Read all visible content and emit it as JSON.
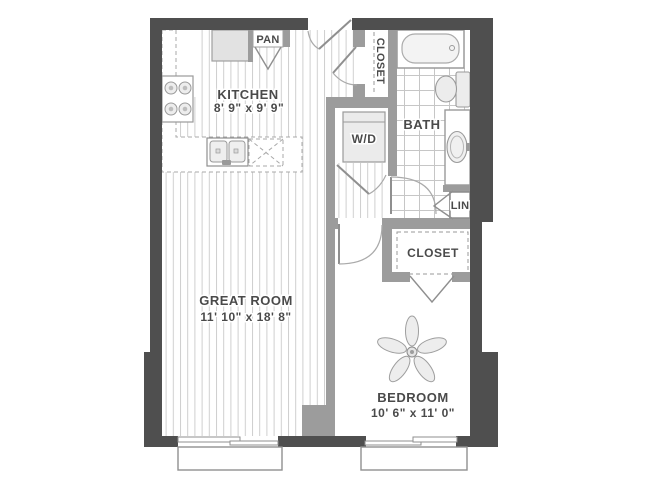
{
  "plan": {
    "type": "apartment-floor-plan",
    "rooms": {
      "kitchen": {
        "name": "KITCHEN",
        "dims": "8' 9\" x 9' 9\""
      },
      "great_room": {
        "name": "GREAT ROOM",
        "dims": "11' 10\" x 18' 8\""
      },
      "bedroom": {
        "name": "BEDROOM",
        "dims": "10' 6\" x 11' 0\""
      },
      "bath": {
        "name": "BATH"
      },
      "pantry": {
        "name": "PAN"
      },
      "entry_closet": {
        "name": "CLOSET"
      },
      "bedroom_closet": {
        "name": "CLOSET"
      },
      "laundry": {
        "name": "W/D"
      },
      "linen": {
        "name": "LIN"
      }
    },
    "icons": [
      "bathtub",
      "toilet",
      "vanity-sink",
      "double-kitchen-sink",
      "range-burners",
      "refrigerator",
      "pantry-bifold-doors",
      "washer-dryer",
      "ceiling-fan",
      "door-swing",
      "closet-rod-dashes",
      "island-dashed-x",
      "window",
      "balcony"
    ],
    "colors": {
      "exterior_wall": "#4f4f4f",
      "interior_wall": "#9c9c9c",
      "plank_line": "#cfcfcf",
      "tile_line": "#c6c6c6",
      "fixture_stroke": "#9a9a9a",
      "label_text": "#4a4a4a",
      "background": "#ffffff"
    }
  }
}
